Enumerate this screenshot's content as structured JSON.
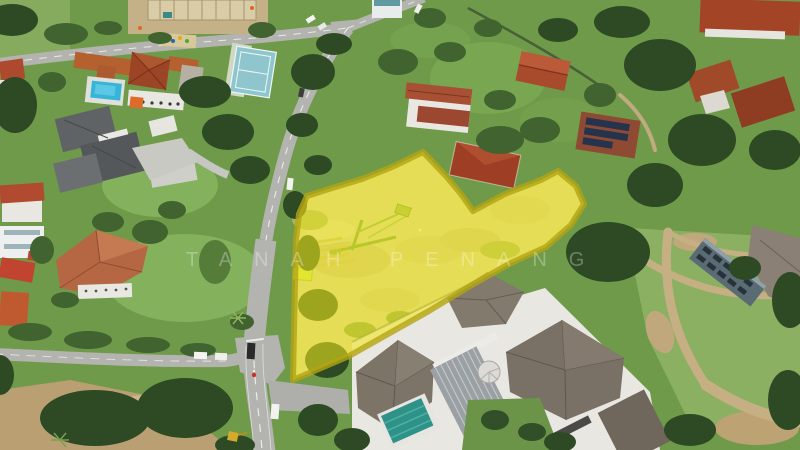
{
  "scene": {
    "description": "Aerial drone photograph of a suburban neighborhood (Penang) with a vacant land parcel highlighted by a semi-transparent yellow polygon overlay, a main road running top-to-bottom with a junction at lower left, a school compound with pool and sports court at upper left, and a large gray-roofed mansion at lower center",
    "highlighted_parcel_label": "yellow highlighted land parcel"
  },
  "watermark": {
    "text": "TANAH PENANG"
  },
  "palette": {
    "watermark": "rgba(255,255,255,0.30)",
    "grassBase": "#6f9a4a",
    "lawn": "#84b15c",
    "field": "#8bb062",
    "treeDark": "#2d4a24",
    "treeMid": "#40632f",
    "treeLight": "#567c3a",
    "road": "#b3b3af",
    "roadLine": "#f2f2ee",
    "roofRed": "#a84a2c",
    "roofTerracotta": "#b5602f",
    "roofGray": "#5d6164",
    "mansionRoof": "#7d7468",
    "metalRoof": "#9aa0a3",
    "whiteWall": "#e9e7e2",
    "pool": "#35b6d9",
    "lapPool": "#2f9288",
    "court": "#8fc6ce",
    "dirt": "#c5b188",
    "earth": "#d7cfa4",
    "highlightFill": "#f0e71c",
    "highlightStroke": "#b3a513",
    "solar": "#26334d",
    "grayBuilding": "#5a6b74"
  }
}
